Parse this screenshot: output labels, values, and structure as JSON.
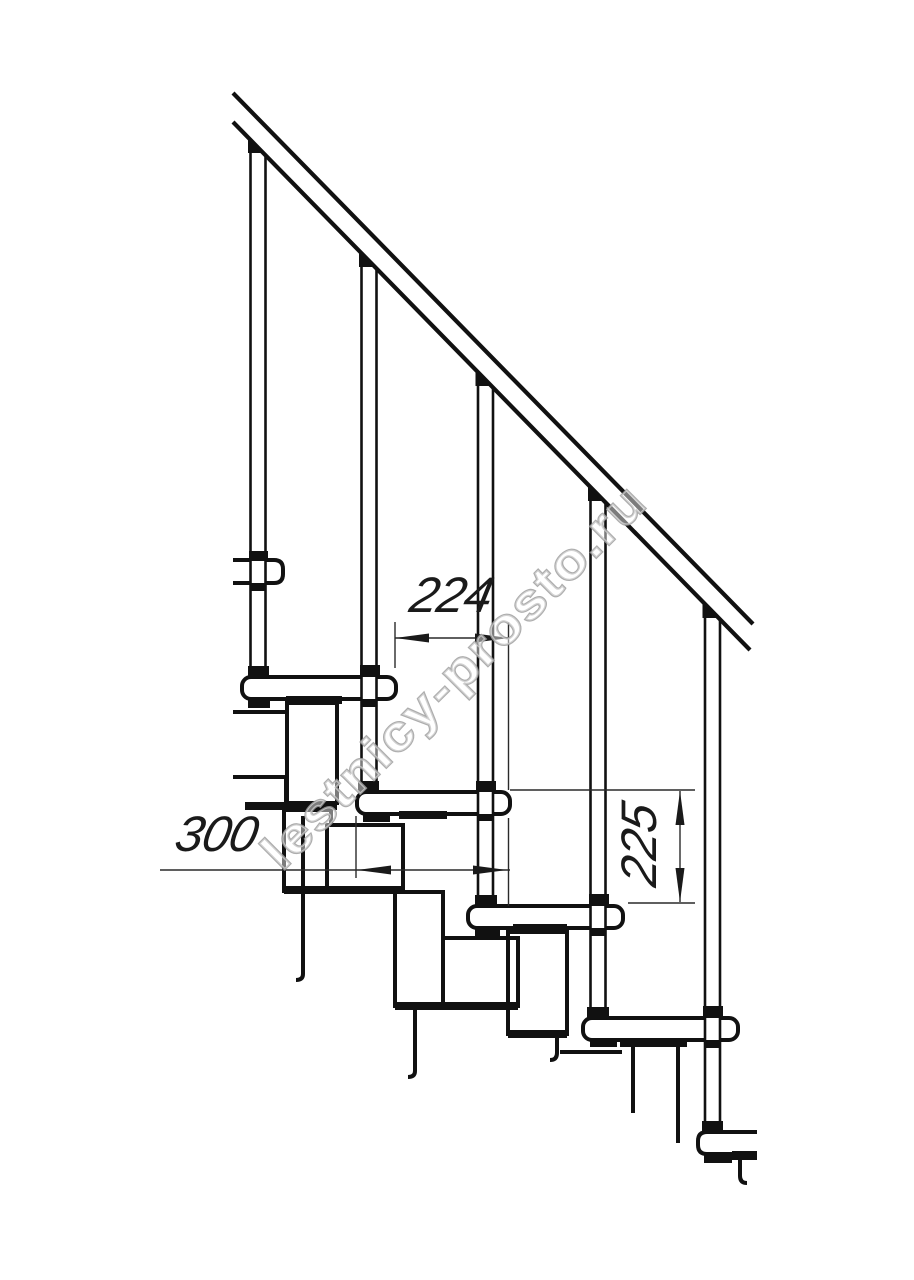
{
  "page": {
    "background": "#ffffff"
  },
  "drawing": {
    "kind": "technical-line-drawing",
    "subject": "modular staircase side view fragment",
    "theme": {
      "line": "#111111",
      "thin_line": "#2a2a2a",
      "text": "#1a1a1a",
      "watermark": "#9f9f9f",
      "background": "#ffffff"
    },
    "dimensions": {
      "going": "224",
      "tread_depth": "300",
      "rise": "225"
    },
    "watermark": {
      "text": "lestnicy-prosto.ru"
    },
    "counts": {
      "balusters": 5,
      "treads": 6
    }
  }
}
